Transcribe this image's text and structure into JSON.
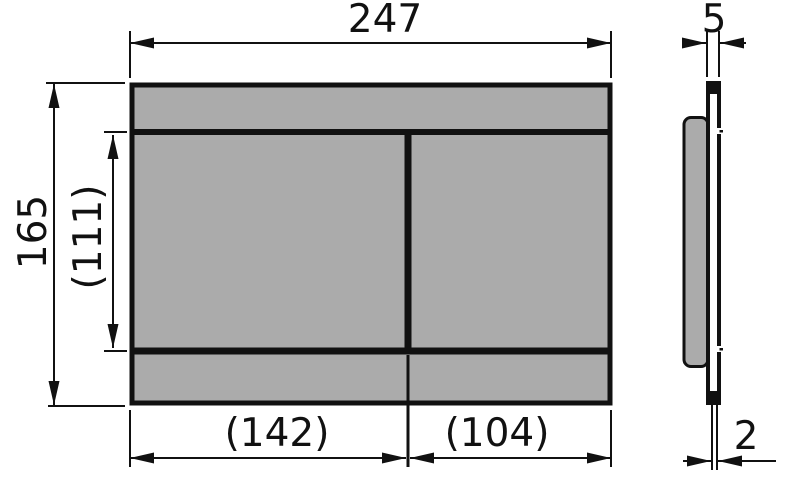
{
  "drawing": {
    "title": "flush-plate-dimensional-drawing",
    "colors": {
      "background": "#ffffff",
      "line": "#111111",
      "plate_fill": "#ababab"
    },
    "front_view": {
      "width_label": "247",
      "height_label": "165",
      "inner_height_label": "(111)",
      "left_button_width_label": "(142)",
      "right_button_width_label": "(104)"
    },
    "side_view": {
      "depth_label": "5",
      "panel_thickness_label": "2"
    }
  }
}
